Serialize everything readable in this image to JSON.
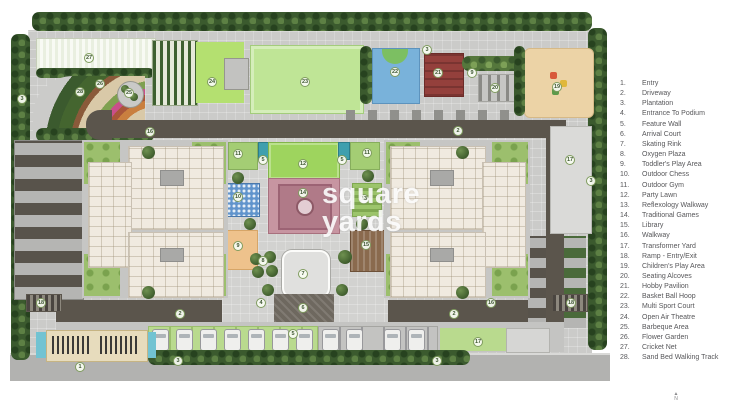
{
  "legend": {
    "items": [
      {
        "num": "1.",
        "label": "Entry"
      },
      {
        "num": "2.",
        "label": "Driveway"
      },
      {
        "num": "3.",
        "label": "Plantation"
      },
      {
        "num": "4.",
        "label": "Entrance To Podium"
      },
      {
        "num": "5.",
        "label": "Feature Wall"
      },
      {
        "num": "6.",
        "label": "Arrival Court"
      },
      {
        "num": "7.",
        "label": "Skating Rink"
      },
      {
        "num": "8.",
        "label": "Oxygen Plaza"
      },
      {
        "num": "9.",
        "label": "Toddler's Play Area"
      },
      {
        "num": "10.",
        "label": "Outdoor Chess"
      },
      {
        "num": "11.",
        "label": "Outdoor Gym"
      },
      {
        "num": "12.",
        "label": "Party Lawn"
      },
      {
        "num": "13.",
        "label": "Reflexology Walkway"
      },
      {
        "num": "14.",
        "label": "Traditional Games"
      },
      {
        "num": "15.",
        "label": "Library"
      },
      {
        "num": "16.",
        "label": "Walkway"
      },
      {
        "num": "17.",
        "label": "Transformer Yard"
      },
      {
        "num": "18.",
        "label": "Ramp - Entry/Exit"
      },
      {
        "num": "19.",
        "label": "Children's Play Area"
      },
      {
        "num": "20.",
        "label": "Seating Alcoves"
      },
      {
        "num": "21.",
        "label": "Hobby Pavilion"
      },
      {
        "num": "22.",
        "label": "Basket Ball Hoop"
      },
      {
        "num": "23.",
        "label": "Multi Sport Court"
      },
      {
        "num": "24.",
        "label": "Open Air Theatre"
      },
      {
        "num": "25.",
        "label": "Barbeque Area"
      },
      {
        "num": "26.",
        "label": "Flower Garden"
      },
      {
        "num": "27.",
        "label": "Cricket Net"
      },
      {
        "num": "28.",
        "label": "Sand Bed Walking Track"
      }
    ]
  },
  "plan": {
    "markers": [
      {
        "n": "27",
        "x": 89,
        "y": 58
      },
      {
        "n": "28",
        "x": 80,
        "y": 92
      },
      {
        "n": "26",
        "x": 100,
        "y": 84
      },
      {
        "n": "25",
        "x": 129,
        "y": 93
      },
      {
        "n": "3",
        "x": 22,
        "y": 99
      },
      {
        "n": "16",
        "x": 150,
        "y": 132
      },
      {
        "n": "24",
        "x": 212,
        "y": 82
      },
      {
        "n": "23",
        "x": 305,
        "y": 82
      },
      {
        "n": "22",
        "x": 395,
        "y": 72
      },
      {
        "n": "3",
        "x": 427,
        "y": 50
      },
      {
        "n": "21",
        "x": 438,
        "y": 73
      },
      {
        "n": "9",
        "x": 472,
        "y": 73
      },
      {
        "n": "20",
        "x": 495,
        "y": 88
      },
      {
        "n": "19",
        "x": 557,
        "y": 87
      },
      {
        "n": "2",
        "x": 458,
        "y": 131
      },
      {
        "n": "17",
        "x": 570,
        "y": 160
      },
      {
        "n": "3",
        "x": 591,
        "y": 181
      },
      {
        "n": "11",
        "x": 238,
        "y": 154
      },
      {
        "n": "5",
        "x": 263,
        "y": 160
      },
      {
        "n": "12",
        "x": 303,
        "y": 164
      },
      {
        "n": "5",
        "x": 342,
        "y": 160
      },
      {
        "n": "11",
        "x": 367,
        "y": 153
      },
      {
        "n": "10",
        "x": 238,
        "y": 197
      },
      {
        "n": "14",
        "x": 303,
        "y": 193
      },
      {
        "n": "13",
        "x": 364,
        "y": 199
      },
      {
        "n": "9",
        "x": 238,
        "y": 246
      },
      {
        "n": "15",
        "x": 366,
        "y": 245
      },
      {
        "n": "8",
        "x": 263,
        "y": 261
      },
      {
        "n": "7",
        "x": 303,
        "y": 274
      },
      {
        "n": "4",
        "x": 261,
        "y": 303
      },
      {
        "n": "6",
        "x": 303,
        "y": 308
      },
      {
        "n": "5",
        "x": 293,
        "y": 334
      },
      {
        "n": "18",
        "x": 41,
        "y": 303
      },
      {
        "n": "2",
        "x": 180,
        "y": 314
      },
      {
        "n": "1",
        "x": 80,
        "y": 367
      },
      {
        "n": "3",
        "x": 178,
        "y": 361
      },
      {
        "n": "2",
        "x": 454,
        "y": 314
      },
      {
        "n": "16",
        "x": 491,
        "y": 303
      },
      {
        "n": "18",
        "x": 571,
        "y": 303
      },
      {
        "n": "17",
        "x": 478,
        "y": 342
      },
      {
        "n": "3",
        "x": 437,
        "y": 361
      }
    ]
  },
  "watermark": {
    "line1": "square",
    "line2": "yards"
  },
  "compass": {
    "arrow": "▲",
    "label": "N"
  },
  "colors": {
    "driveway": "#5b554c",
    "lawn": "#9cbf6d",
    "sport_court": "#bfe596",
    "basketball_water_blue": "#79b2da",
    "hobby_pavilion_red": "#94403c",
    "play_sand": "#ecd3a6",
    "plaza_pink": "#c795a1",
    "entry_water": "#72c3d2",
    "legend_text": "#57575a"
  }
}
